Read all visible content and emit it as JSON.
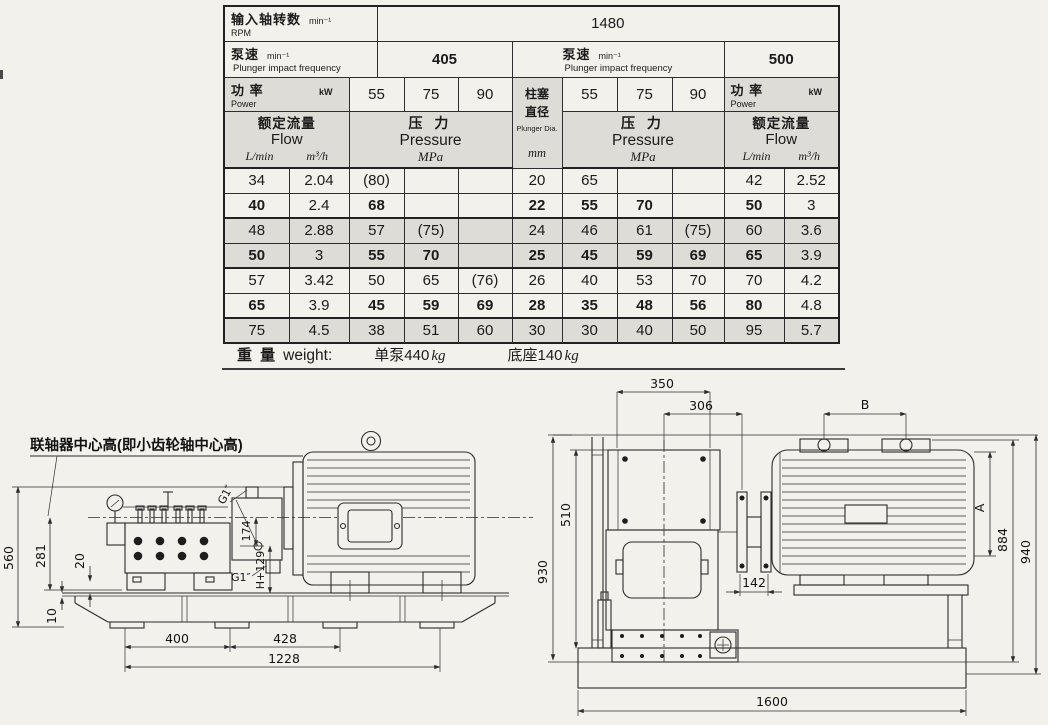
{
  "page": {
    "bg": "#f2f1ec",
    "ink": "#2c2c2c",
    "shade": "#dddcd6"
  },
  "spec_table": {
    "rpm": {
      "zh": "输入轴转数",
      "unit": "min⁻¹",
      "en": "RPM",
      "value": "1480"
    },
    "pump_speed": {
      "zh": "泵速",
      "unit": "min⁻¹",
      "en": "Plunger impact frequency"
    },
    "speed_left": "405",
    "speed_right": "500",
    "power": {
      "zh": "功 率",
      "unit": "kW",
      "en": "Power"
    },
    "power_values": [
      "55",
      "75",
      "90"
    ],
    "plunger": {
      "zh1": "柱塞",
      "zh2": "直径",
      "en": "Plunger Dia.",
      "unit": "mm"
    },
    "flow": {
      "zh": "额定流量",
      "en": "Flow",
      "unit1": "L/min",
      "unit2": "m³/h"
    },
    "pressure": {
      "zh": "压 力",
      "en": "Pressure",
      "unit": "MPa"
    },
    "rows": [
      {
        "bold": false,
        "shaded": false,
        "cells": [
          "34",
          "2.04",
          "(80)",
          "",
          "",
          "20",
          "65",
          "",
          "",
          "42",
          "2.52"
        ]
      },
      {
        "bold": true,
        "shaded": false,
        "cells": [
          "40",
          "2.4",
          "68",
          "",
          "",
          "22",
          "55",
          "70",
          "",
          "50",
          "3"
        ]
      },
      {
        "bold": false,
        "shaded": true,
        "cells": [
          "48",
          "2.88",
          "57",
          "(75)",
          "",
          "24",
          "46",
          "61",
          "(75)",
          "60",
          "3.6"
        ]
      },
      {
        "bold": true,
        "shaded": true,
        "cells": [
          "50",
          "3",
          "55",
          "70",
          "",
          "25",
          "45",
          "59",
          "69",
          "65",
          "3.9"
        ]
      },
      {
        "bold": false,
        "shaded": false,
        "cells": [
          "57",
          "3.42",
          "50",
          "65",
          "(76)",
          "26",
          "40",
          "53",
          "70",
          "70",
          "4.2"
        ]
      },
      {
        "bold": true,
        "shaded": false,
        "cells": [
          "65",
          "3.9",
          "45",
          "59",
          "69",
          "28",
          "35",
          "48",
          "56",
          "80",
          "4.8"
        ]
      },
      {
        "bold": false,
        "shaded": true,
        "cells": [
          "75",
          "4.5",
          "38",
          "51",
          "60",
          "30",
          "30",
          "40",
          "50",
          "95",
          "5.7"
        ]
      }
    ],
    "weight": {
      "label_zh": "重 量",
      "label_en": "weight:",
      "pump_text": "单泵440",
      "base_text": "底座140",
      "kg": "kg"
    }
  },
  "drawings": {
    "side_view": {
      "callout": "联轴器中心高(即小齿轮轴中心高)",
      "dims": {
        "d560": "560",
        "d281": "281",
        "d20": "20",
        "d10": "10",
        "d400": "400",
        "d428": "428",
        "d1228": "1228",
        "d174": "174",
        "dh129": "H+129",
        "g1_top": "G1″",
        "g1_bottom": "G1″"
      }
    },
    "end_view": {
      "dims": {
        "d350": "350",
        "d306": "306",
        "dB": "B",
        "d930": "930",
        "d510": "510",
        "dA": "A",
        "d884": "884",
        "d940": "940",
        "d142": "142",
        "d1600": "1600"
      }
    }
  }
}
